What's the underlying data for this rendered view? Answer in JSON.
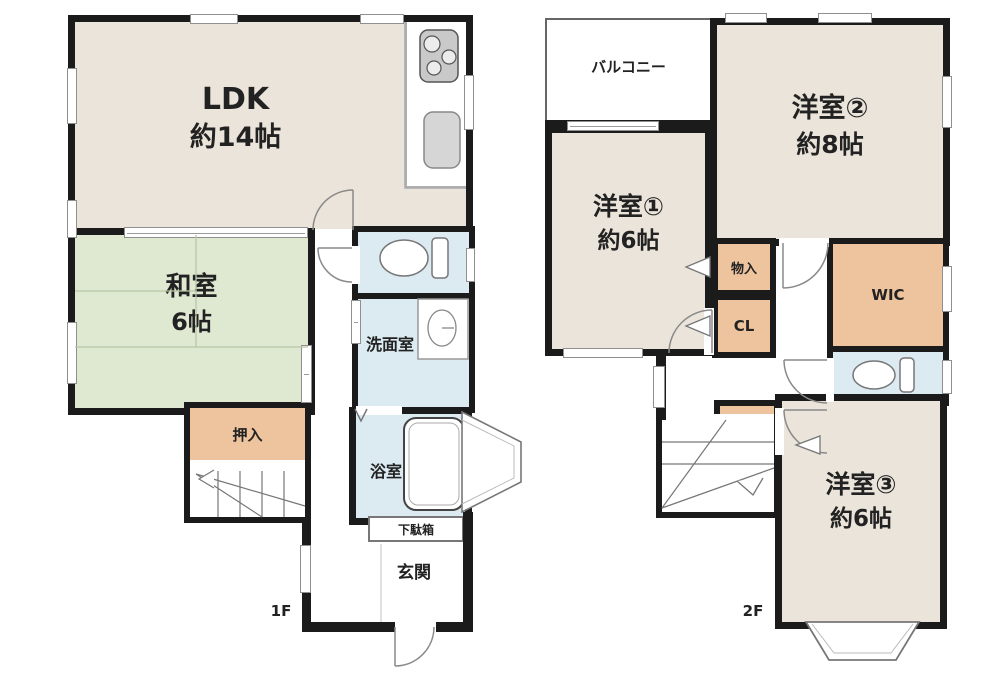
{
  "floor1": {
    "floor_label": "1F",
    "ldk": {
      "name": "LDK",
      "size": "約14帖"
    },
    "washitsu": {
      "name": "和室",
      "size": "6帖"
    },
    "oshiire": {
      "name": "押入"
    },
    "senmenshitsu": {
      "name": "洗面室"
    },
    "yokushitsu": {
      "name": "浴室"
    },
    "getabako": {
      "name": "下駄箱"
    },
    "genkan": {
      "name": "玄関"
    }
  },
  "floor2": {
    "floor_label": "2F",
    "balcony": {
      "name": "バルコニー"
    },
    "yoshitsu1": {
      "name": "洋室①",
      "size": "約6帖"
    },
    "yoshitsu2": {
      "name": "洋室②",
      "size": "約8帖"
    },
    "yoshitsu3": {
      "name": "洋室③",
      "size": "約6帖"
    },
    "monoire_upper": {
      "name": "物入"
    },
    "closet": {
      "name": "CL"
    },
    "wic": {
      "name": "WIC"
    },
    "monoire_lower": {
      "name": "物入"
    }
  },
  "colors": {
    "wall": "#1b1b1b",
    "room_beige": "#eae4da",
    "tatami_green": "#dfe9d2",
    "water_blue": "#dcebf2",
    "closet_tan": "#eec49f"
  }
}
